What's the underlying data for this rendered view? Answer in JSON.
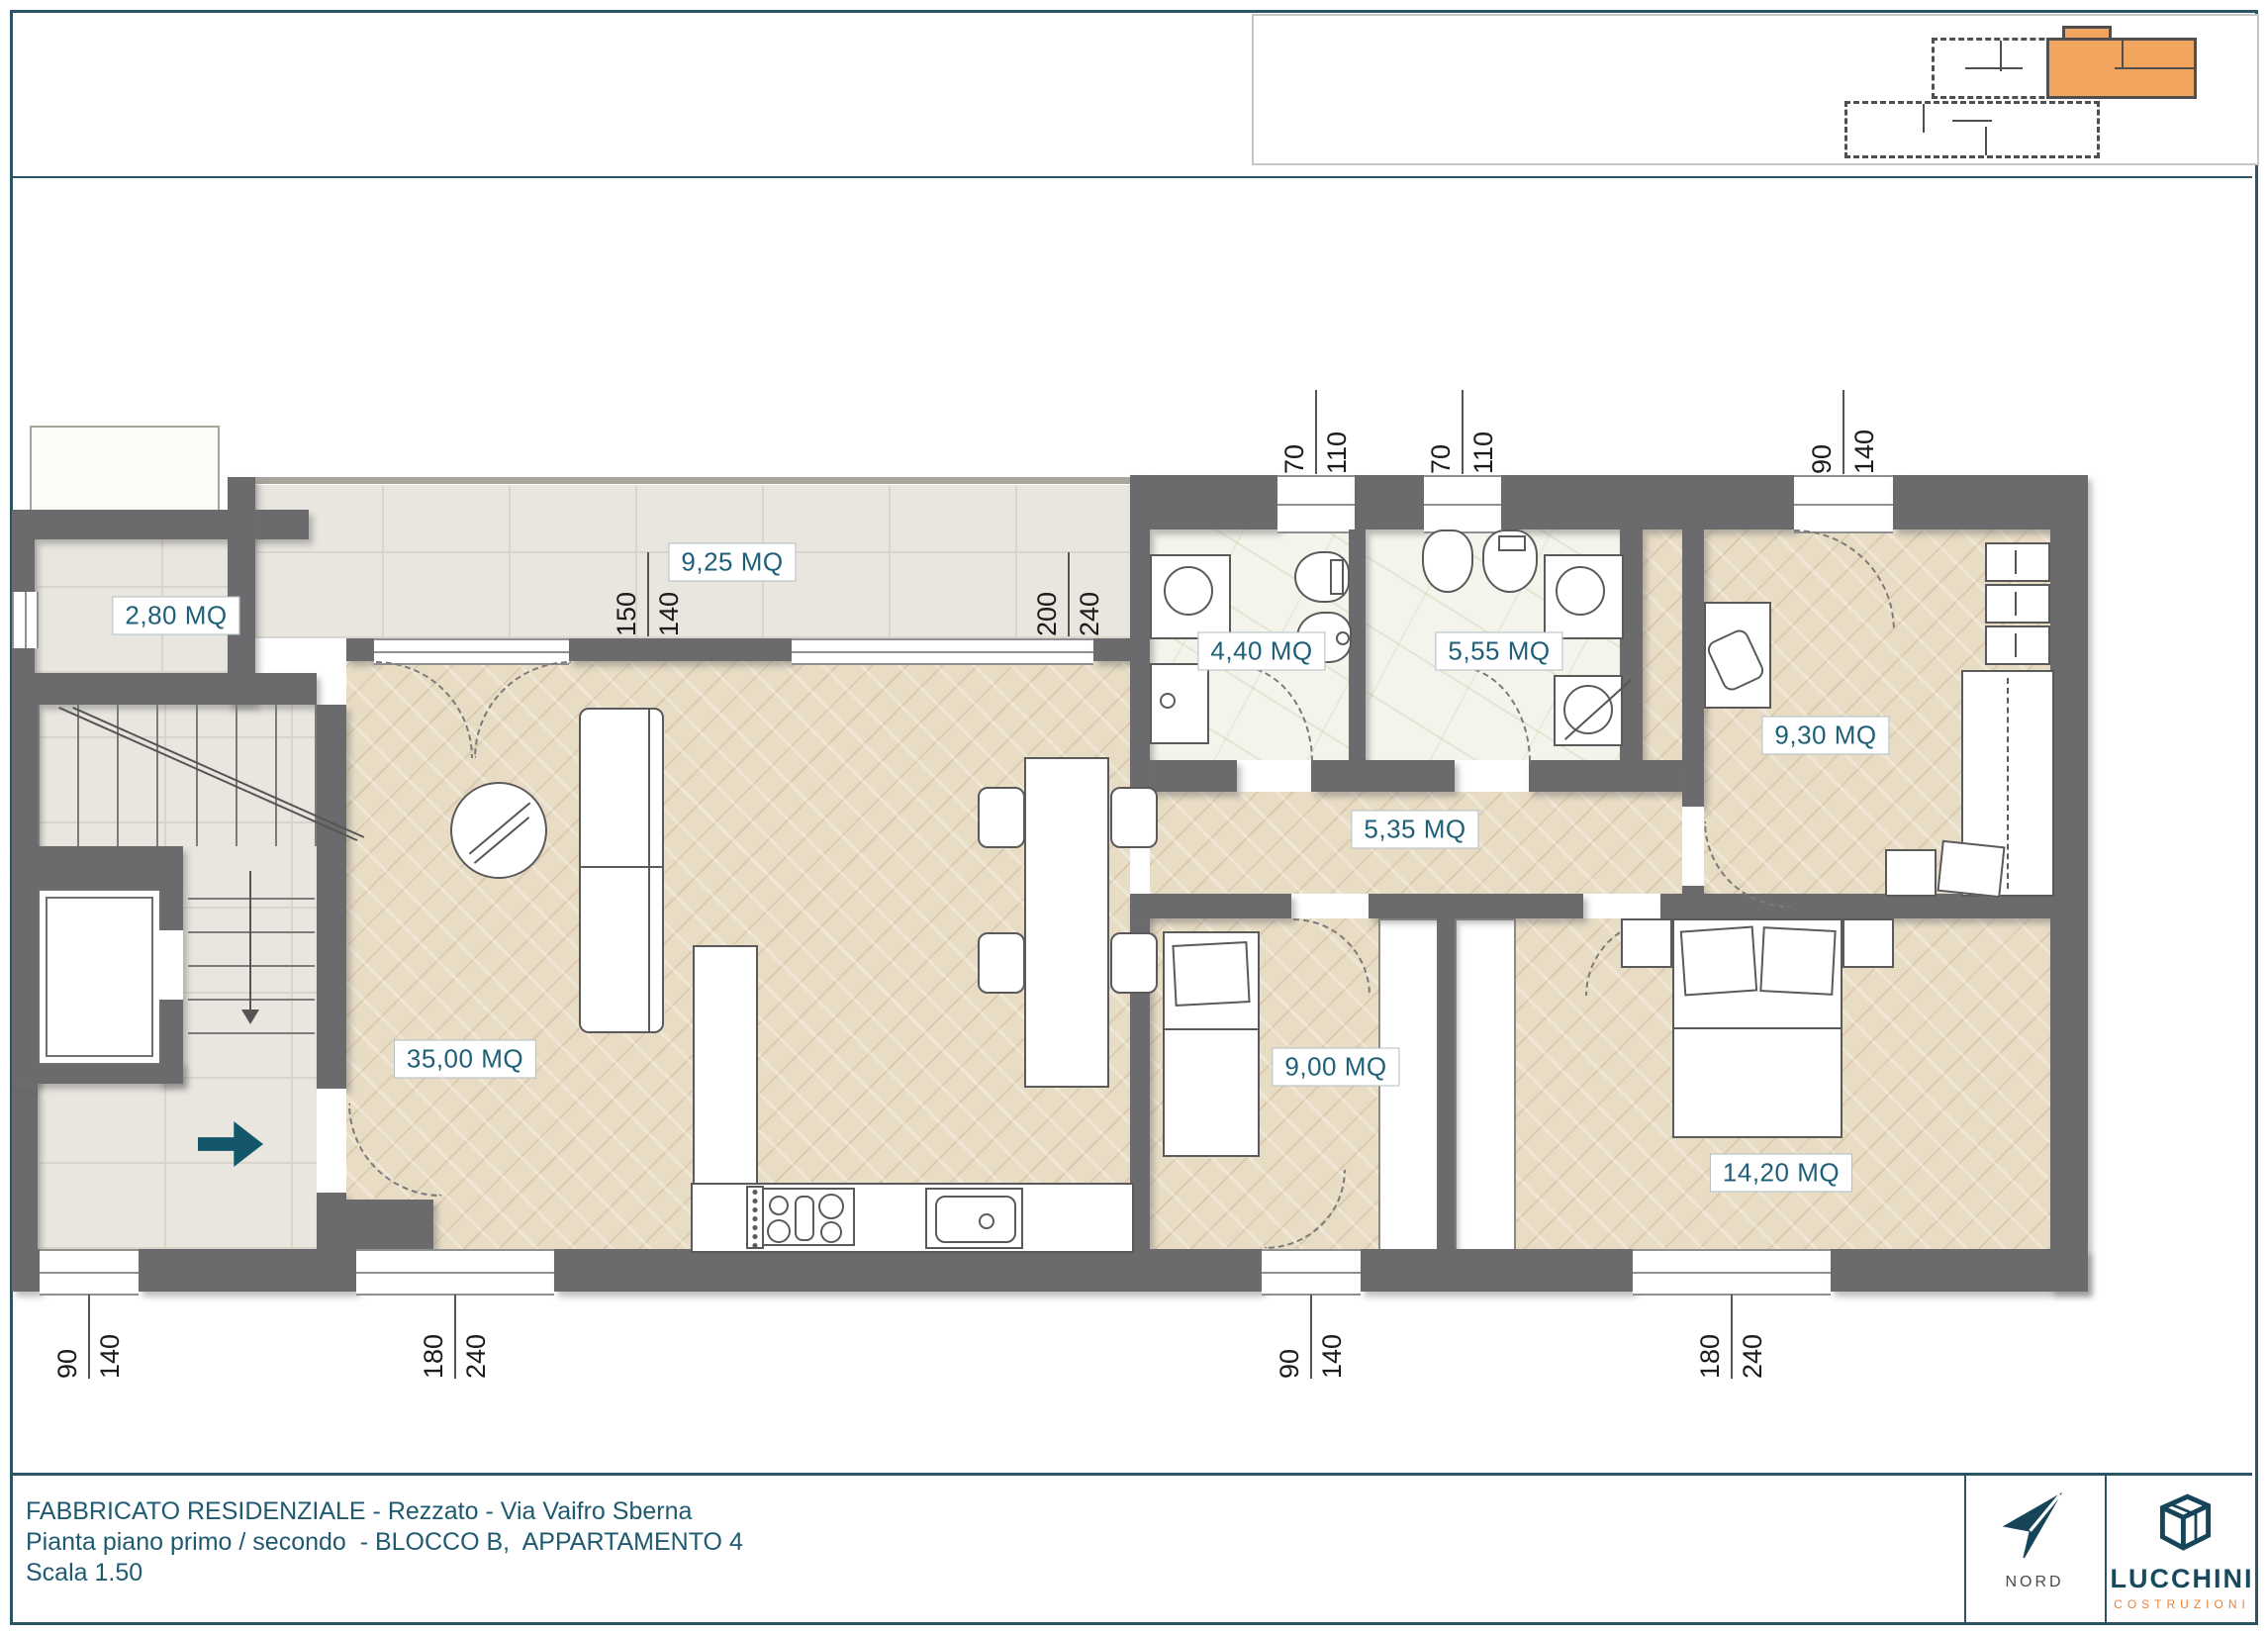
{
  "rooms": {
    "balcony": {
      "label": "2,80 MQ"
    },
    "terrace": {
      "label": "9,25 MQ"
    },
    "living": {
      "label": "35,00 MQ"
    },
    "bath1": {
      "label": "4,40 MQ"
    },
    "bath2": {
      "label": "5,55 MQ"
    },
    "hallway": {
      "label": "5,35 MQ"
    },
    "bedroom1": {
      "label": "9,30 MQ"
    },
    "bedroom2": {
      "label": "9,00 MQ"
    },
    "bedroom3": {
      "label": "14,20 MQ"
    }
  },
  "dimensions": {
    "top": [
      {
        "a": "70",
        "b": "110"
      },
      {
        "a": "70",
        "b": "110"
      },
      {
        "a": "90",
        "b": "140"
      }
    ],
    "mid": [
      {
        "a": "150",
        "b": "140"
      },
      {
        "a": "200",
        "b": "240"
      }
    ],
    "bottom": [
      {
        "a": "90",
        "b": "140"
      },
      {
        "a": "180",
        "b": "240"
      },
      {
        "a": "90",
        "b": "140"
      },
      {
        "a": "180",
        "b": "240"
      }
    ]
  },
  "titleblock": {
    "line1": "FABBRICATO RESIDENZIALE - Rezzato - Via Vaifro Sberna",
    "line2": "Pianta piano primo / secondo  - BLOCCO B,  APPARTAMENTO 4",
    "line3": "Scala 1.50"
  },
  "compass": {
    "label": "NORD"
  },
  "logo": {
    "name": "LUCCHINI",
    "subtitle": "COSTRUZIONI"
  },
  "colors": {
    "accent_teal": "#2b5564",
    "label_teal": "#1f6078",
    "wall_gray": "#6b6b6d",
    "highlight_orange": "#f2a55f",
    "logo_orange": "#e8823a",
    "entry_arrow_teal": "#14576b"
  }
}
